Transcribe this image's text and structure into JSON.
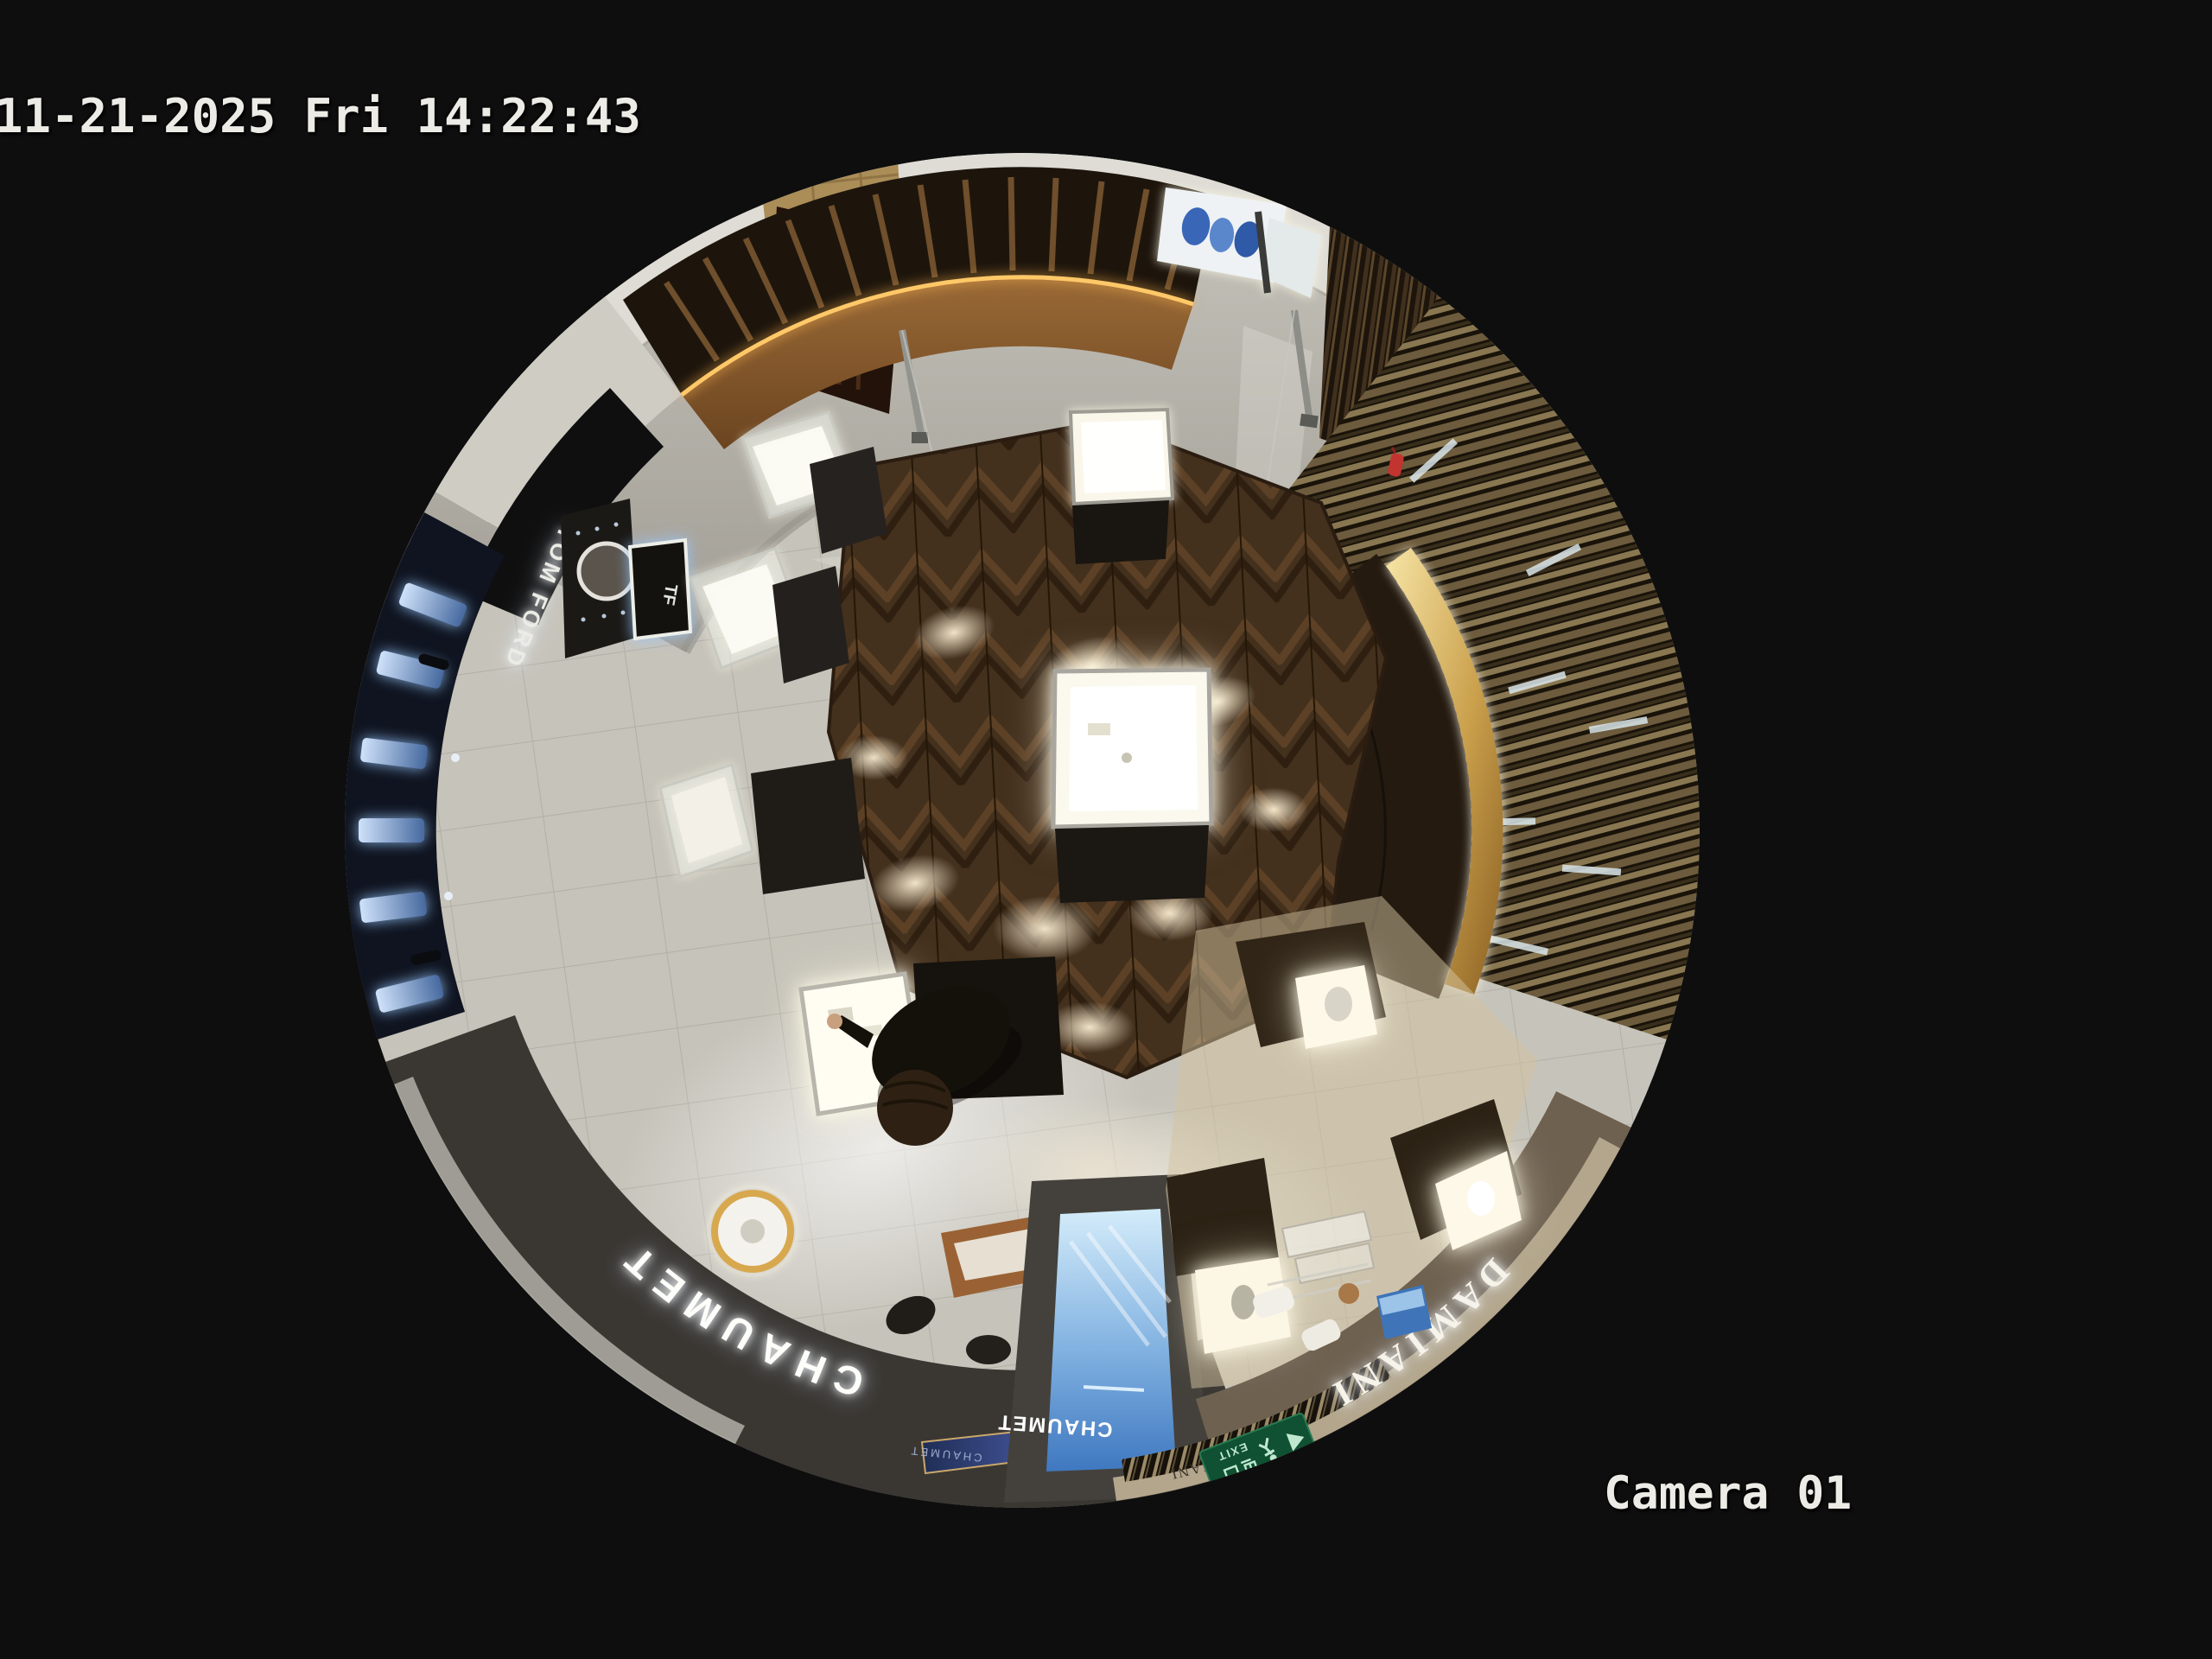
{
  "overlay": {
    "timestamp": "11-21-2025 Fri 14:22:43",
    "camera_label": "Camera 01"
  },
  "scene": {
    "signs": {
      "chaumet_fascia": "CHAUMET",
      "chaumet_plaque": "CHAUMET",
      "chaumet_screen_ad": "CHAUMET",
      "damiani_fascia": "DAMIANI",
      "damiani_rim_plaque": "DAMIANI",
      "tom_ford_fascia": "TOM FORD",
      "tf_logo_frame": "TF",
      "la_mer_window": "LA MER",
      "exit_sign_text": "EXIT",
      "exit_sign_chinese": "出口"
    },
    "colors": {
      "background": "#0e0e0e",
      "overlay_text": "#ecebe6",
      "parquet_wood": "#43301d",
      "marble_floor": "#b4b1a9",
      "gold_trim": "#d8a84e",
      "exit_green": "#0f5132",
      "screen_blue": "#4f8fd4",
      "led_amber": "#ffc05e"
    }
  }
}
